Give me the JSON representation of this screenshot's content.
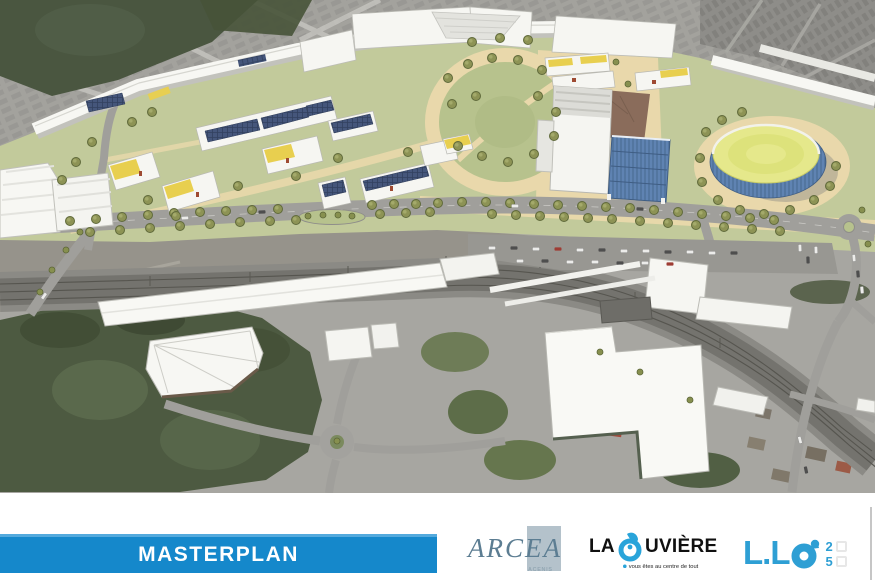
{
  "banner": {
    "label": "MASTERPLAN"
  },
  "logos": {
    "arcea": {
      "name": "ARCEA",
      "subtext": "ACENIS"
    },
    "la_louviere": {
      "prefix": "LA",
      "suffix": "UVIÈRE",
      "tagline": "vous êtes au centre de tout"
    },
    "llo25": {
      "prefix": "L.L",
      "digit_top": "2",
      "digit_bottom": "5"
    }
  },
  "colors": {
    "banner_blue": "#1588cb",
    "banner_edge": "#54aadd",
    "louviere_blue": "#29a4da",
    "llo_blue": "#2e9fd4",
    "arcea_text": "#5c7d92",
    "arcea_box": "#b4c2cb"
  }
}
